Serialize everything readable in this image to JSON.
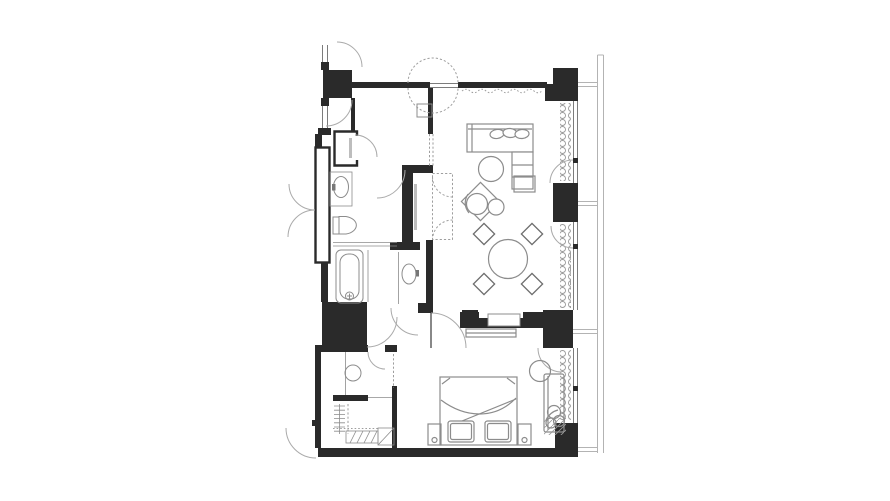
{
  "page": {
    "background": "#ffffff"
  },
  "palette": {
    "wall": "#2a2a2a",
    "window_line": "#7c7c7c",
    "outer_line": "#b3b3b3",
    "furniture_line": "#8c8c8c",
    "fixture_line": "#8c8c8c",
    "dashed_line": "#9e9e9e",
    "door_arc_line": "#aaaaaa",
    "rail_gray": "#bdbdbd"
  },
  "plan": {
    "type": "hotel-suite-floor-plan",
    "rooms": [
      "entry-vestibule",
      "living-room",
      "dining-area",
      "bedroom",
      "bathroom",
      "vanity-room",
      "wc",
      "walk-in-closet",
      "hallway"
    ],
    "living_room_furniture": [
      "l-shaped-sofa",
      "sofa-pillows-x3",
      "round-coffee-table",
      "lounge-chair",
      "ottoman",
      "side-table",
      "round-dining-table",
      "dining-chairs-x4",
      "tv-cabinet"
    ],
    "bedroom_furniture": [
      "double-bed",
      "bed-pillows-x2",
      "nightstands-x2",
      "media-console",
      "chaise-bench",
      "round-side-table",
      "potted-plant"
    ],
    "bathroom_fixtures": [
      "vanity-washbasin",
      "toilet",
      "bathtub",
      "second-washbasin",
      "round-fixture"
    ],
    "closet_elements": [
      "entry-closet",
      "dashed-wardrobe",
      "hanging-rail-with-hangers",
      "lower-rack-hatched",
      "luggage-rack"
    ],
    "structure": [
      "concrete-columns-x6",
      "window-wall-left",
      "window-wall-right",
      "facade-outer-line",
      "curtain-coils",
      "door-swing-arcs",
      "dashed-double-swing-entry-door",
      "service-shaft"
    ]
  }
}
